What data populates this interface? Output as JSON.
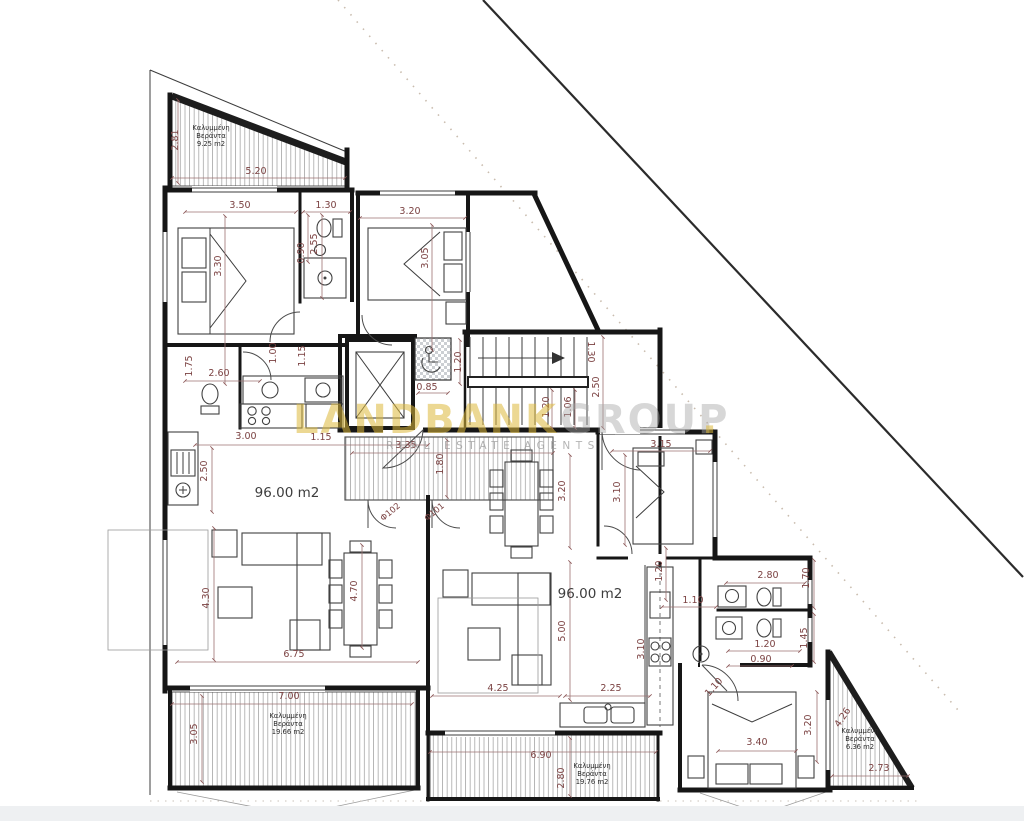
{
  "watermark": {
    "brand_primary": "LANDBANK",
    "brand_secondary": "GROUP",
    "dot": ".",
    "tagline": "REAL ESTATE AGENTS",
    "primary_color": "#ddb93c",
    "secondary_color": "#a8a8a8"
  },
  "plan": {
    "apartment_area_labels": [
      {
        "text": "96.00 m2",
        "x": 287,
        "y": 497
      },
      {
        "text": "96.00 m2",
        "x": 590,
        "y": 598
      }
    ],
    "veranda_labels": [
      {
        "lines": [
          "Καλυμμένη",
          "Βεράντα",
          "9.25 m2"
        ],
        "x": 211,
        "y": 130,
        "lh": 8
      },
      {
        "lines": [
          "Καλυμμένη",
          "Βεράντα",
          "19.66 m2"
        ],
        "x": 288,
        "y": 718,
        "lh": 8
      },
      {
        "lines": [
          "Καλυμμένη",
          "Βεράντα",
          "19.76 m2"
        ],
        "x": 592,
        "y": 768,
        "lh": 8
      },
      {
        "lines": [
          "Καλυμμένη",
          "Βεράντα",
          "6.36 m2"
        ],
        "x": 860,
        "y": 733,
        "lh": 8
      }
    ],
    "door_labels": [
      {
        "text": "Φ102",
        "x": 392,
        "y": 514,
        "rot": -40
      },
      {
        "text": "Φ101",
        "x": 436,
        "y": 514,
        "rot": -40
      }
    ],
    "dimension_labels": [
      {
        "text": "2.81",
        "x": 178,
        "y": 140,
        "rot": -90
      },
      {
        "text": "5.20",
        "x": 256,
        "y": 174,
        "rot": 0
      },
      {
        "text": "3.50",
        "x": 240,
        "y": 208,
        "rot": 0
      },
      {
        "text": "1.30",
        "x": 326,
        "y": 208,
        "rot": 0
      },
      {
        "text": "3.20",
        "x": 410,
        "y": 214,
        "rot": 0
      },
      {
        "text": "3.30",
        "x": 221,
        "y": 266,
        "rot": -90
      },
      {
        "text": "2.55",
        "x": 317,
        "y": 244,
        "rot": -90
      },
      {
        "text": "0.90",
        "x": 304,
        "y": 253,
        "rot": -90
      },
      {
        "text": "3.05",
        "x": 428,
        "y": 258,
        "rot": -90
      },
      {
        "text": "1.00",
        "x": 276,
        "y": 353,
        "rot": -90
      },
      {
        "text": "1.15",
        "x": 305,
        "y": 356,
        "rot": -90
      },
      {
        "text": "1.75",
        "x": 192,
        "y": 366,
        "rot": -90
      },
      {
        "text": "2.60",
        "x": 219,
        "y": 376,
        "rot": 0
      },
      {
        "text": "0.85",
        "x": 427,
        "y": 390,
        "rot": 0
      },
      {
        "text": "1.20",
        "x": 461,
        "y": 362,
        "rot": -90
      },
      {
        "text": "1.30",
        "x": 588,
        "y": 352,
        "rot": 90
      },
      {
        "text": "2.50",
        "x": 599,
        "y": 387,
        "rot": -90
      },
      {
        "text": "1.20",
        "x": 549,
        "y": 407,
        "rot": -90
      },
      {
        "text": "1.06",
        "x": 571,
        "y": 407,
        "rot": -90
      },
      {
        "text": "3.00",
        "x": 246,
        "y": 439,
        "rot": 0
      },
      {
        "text": "1.15",
        "x": 321,
        "y": 440,
        "rot": 0
      },
      {
        "text": "2.50",
        "x": 207,
        "y": 471,
        "rot": -90
      },
      {
        "text": "3.35",
        "x": 406,
        "y": 448,
        "rot": 0
      },
      {
        "text": "1.80",
        "x": 443,
        "y": 464,
        "rot": -90
      },
      {
        "text": "3.15",
        "x": 661,
        "y": 447,
        "rot": 0
      },
      {
        "text": "3.20",
        "x": 565,
        "y": 491,
        "rot": -90
      },
      {
        "text": "3.10",
        "x": 620,
        "y": 492,
        "rot": -90
      },
      {
        "text": "1.20",
        "x": 662,
        "y": 571,
        "rot": -90
      },
      {
        "text": "2.80",
        "x": 768,
        "y": 578,
        "rot": 0
      },
      {
        "text": "1.70",
        "x": 809,
        "y": 578,
        "rot": -90
      },
      {
        "text": "1.10",
        "x": 693,
        "y": 603,
        "rot": 0
      },
      {
        "text": "5.00",
        "x": 565,
        "y": 631,
        "rot": -90
      },
      {
        "text": "3.10",
        "x": 644,
        "y": 649,
        "rot": -90
      },
      {
        "text": "1.45",
        "x": 807,
        "y": 638,
        "rot": -90
      },
      {
        "text": "1.20",
        "x": 765,
        "y": 647,
        "rot": 0
      },
      {
        "text": "0.90",
        "x": 761,
        "y": 662,
        "rot": 0
      },
      {
        "text": "4.30",
        "x": 209,
        "y": 598,
        "rot": -90
      },
      {
        "text": "4.70",
        "x": 357,
        "y": 591,
        "rot": -90
      },
      {
        "text": "6.75",
        "x": 294,
        "y": 657,
        "rot": 0
      },
      {
        "text": "4.25",
        "x": 498,
        "y": 691,
        "rot": 0
      },
      {
        "text": "2.25",
        "x": 611,
        "y": 691,
        "rot": 0
      },
      {
        "text": "7.00",
        "x": 289,
        "y": 699,
        "rot": 0
      },
      {
        "text": "3.05",
        "x": 197,
        "y": 734,
        "rot": -90
      },
      {
        "text": "6.90",
        "x": 541,
        "y": 758,
        "rot": 0
      },
      {
        "text": "2.80",
        "x": 564,
        "y": 778,
        "rot": -90
      },
      {
        "text": "1.10",
        "x": 716,
        "y": 689,
        "rot": -48
      },
      {
        "text": "3.40",
        "x": 757,
        "y": 745,
        "rot": 0
      },
      {
        "text": "3.20",
        "x": 811,
        "y": 725,
        "rot": -90
      },
      {
        "text": "4.26",
        "x": 845,
        "y": 719,
        "rot": -56
      },
      {
        "text": "2.73",
        "x": 879,
        "y": 771,
        "rot": 0
      }
    ]
  }
}
